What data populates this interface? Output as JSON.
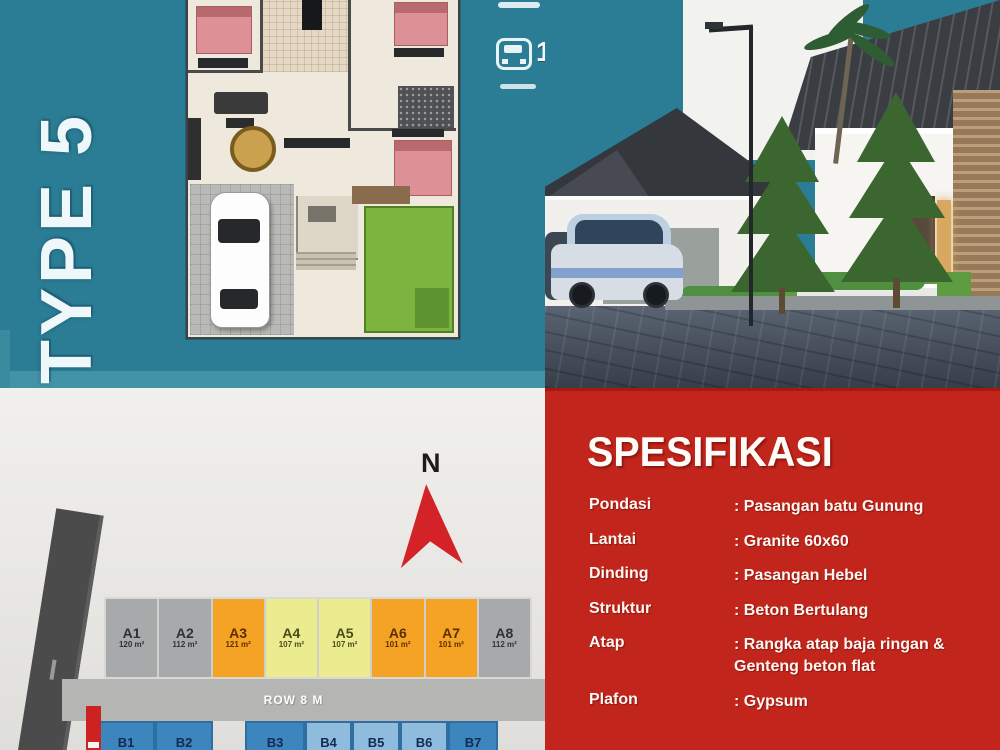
{
  "brand": {
    "type_label": "TYPE 5"
  },
  "badges": {
    "carport_count": "1"
  },
  "siteplan": {
    "compass_label": "N",
    "road_label": "ROW 8 M",
    "row_a": [
      {
        "id": "A1",
        "area": "120 m²",
        "color": "gray"
      },
      {
        "id": "A2",
        "area": "112 m²",
        "color": "gray"
      },
      {
        "id": "A3",
        "area": "121 m²",
        "color": "orange"
      },
      {
        "id": "A4",
        "area": "107 m²",
        "color": "yellow"
      },
      {
        "id": "A5",
        "area": "107 m²",
        "color": "yellow"
      },
      {
        "id": "A6",
        "area": "101 m²",
        "color": "orange"
      },
      {
        "id": "A7",
        "area": "101 m²",
        "color": "orange"
      },
      {
        "id": "A8",
        "area": "112 m²",
        "color": "gray"
      }
    ],
    "row_b": [
      {
        "id": "B1"
      },
      {
        "id": "B2"
      },
      {
        "id": "B3"
      },
      {
        "id": "B4"
      },
      {
        "id": "B5"
      },
      {
        "id": "B6"
      },
      {
        "id": "B7"
      }
    ]
  },
  "specs": {
    "title": "SPESIFIKASI",
    "items": [
      {
        "label": "Pondasi",
        "value": ": Pasangan batu Gunung"
      },
      {
        "label": "Lantai",
        "value": ": Granite 60x60"
      },
      {
        "label": "Dinding",
        "value": ": Pasangan Hebel"
      },
      {
        "label": "Struktur",
        "value": ": Beton Bertulang"
      },
      {
        "label": "Atap",
        "value": ": Rangka atap baja ringan & Genteng beton flat"
      },
      {
        "label": "Plafon",
        "value": ": Gypsum"
      }
    ]
  },
  "colors": {
    "teal": "#2b7d95",
    "panel_red": "#c2251b",
    "arrow_red": "#d42328",
    "plot_gray": "#a7a9ab",
    "plot_orange": "#f5a324",
    "plot_yellow": "#ebeb90",
    "plot_blue_dark": "#3d85bd",
    "plot_blue_light": "#8fbcdd"
  }
}
